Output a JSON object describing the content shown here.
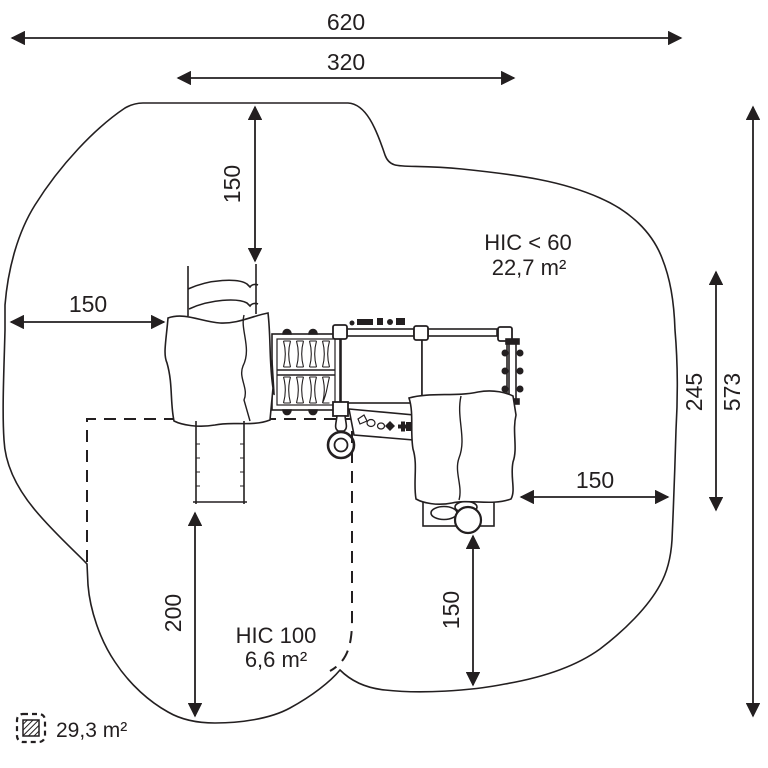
{
  "figure_type": "playground-equipment-safety-area-plan",
  "colors": {
    "line": "#231f20",
    "background": "#ffffff"
  },
  "dimensions": {
    "total_width": "620",
    "inner_width": "320",
    "top_clearance": "150",
    "left_clearance": "150",
    "right_inner_height": "245",
    "total_height": "573",
    "right_clearance": "150",
    "bottom_clearance": "150",
    "slide_runout": "200"
  },
  "zones": {
    "hic60": {
      "title": "HIC < 60",
      "area": "22,7 m²"
    },
    "hic100": {
      "title": "HIC 100",
      "area": "6,6 m²"
    },
    "legend_total_area": "29,3 m²"
  },
  "icons": [
    "safety-area-outline",
    "hic100-dashed-zone",
    "climbing-boulder-left-icon",
    "climbing-boulder-right-icon",
    "rope-net-bridge-icon",
    "platform-deck-icon",
    "vertical-ladder-icon",
    "slide-icon",
    "canopy-icon",
    "firemans-pole-icon",
    "play-panel-icon",
    "balance-pods-icon",
    "hatched-area-legend-icon"
  ]
}
